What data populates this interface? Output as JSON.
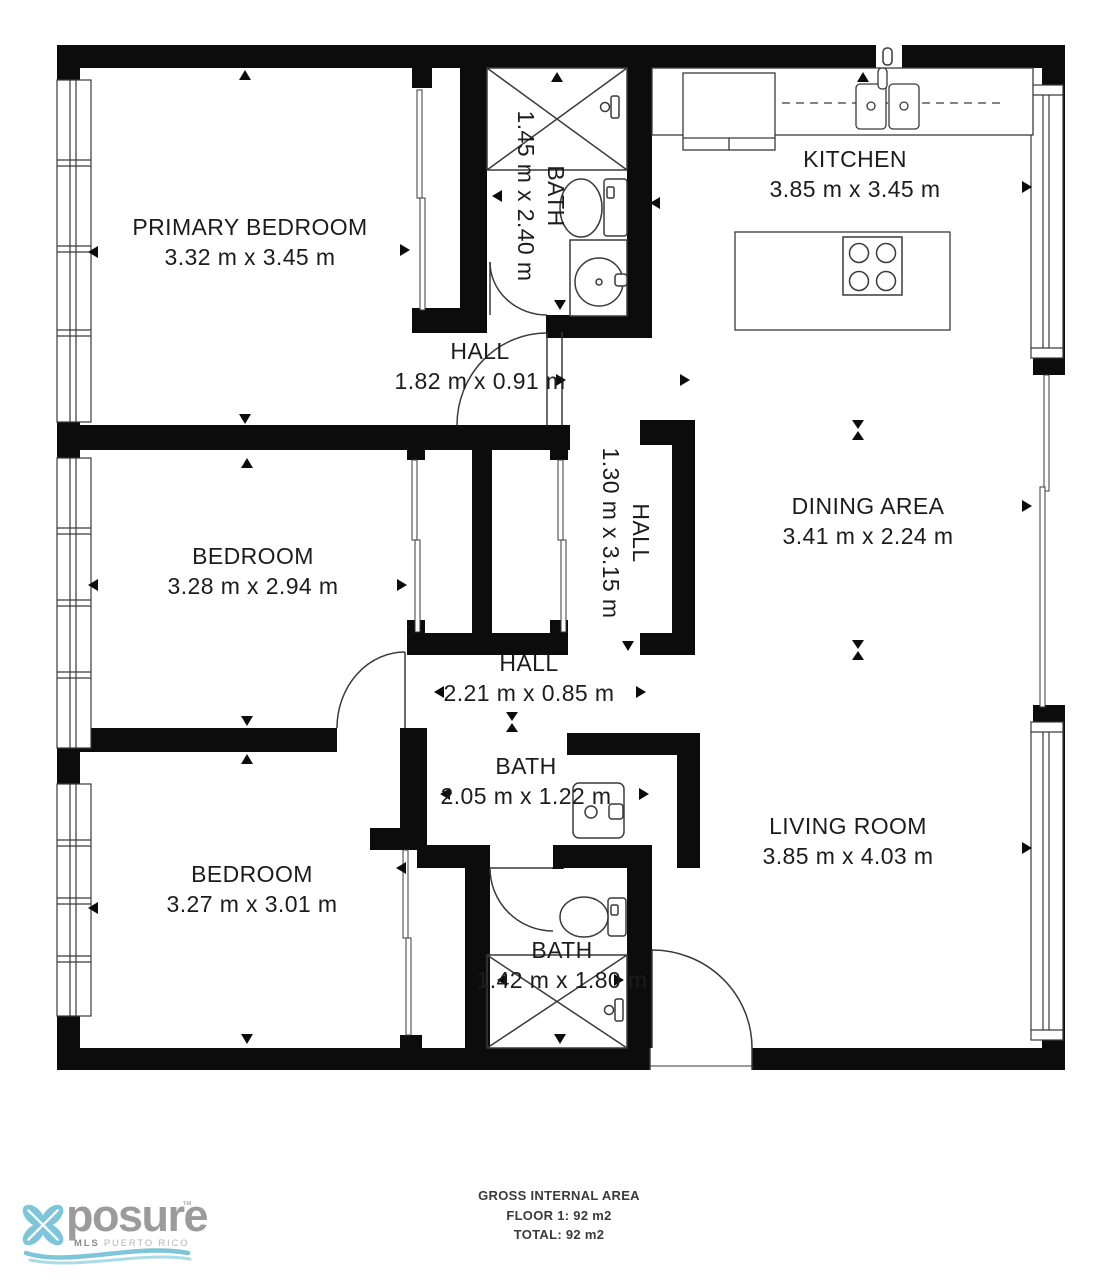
{
  "plan": {
    "rooms": [
      {
        "name": "PRIMARY BEDROOM",
        "dims": "3.32 m x 3.45 m"
      },
      {
        "name": "KITCHEN",
        "dims": "3.85 m x 3.45 m"
      },
      {
        "name": "BATH",
        "dims": "1.45 m x 2.40 m"
      },
      {
        "name": "HALL",
        "dims": "1.82 m x 0.91 m"
      },
      {
        "name": "HALL",
        "dims": "1.30 m x 3.15 m"
      },
      {
        "name": "DINING AREA",
        "dims": "3.41 m x 2.24 m"
      },
      {
        "name": "BEDROOM",
        "dims": "3.28 m x 2.94 m"
      },
      {
        "name": "HALL",
        "dims": "2.21 m x 0.85 m"
      },
      {
        "name": "BATH",
        "dims": "2.05 m x 1.22 m"
      },
      {
        "name": "LIVING ROOM",
        "dims": "3.85 m x 4.03 m"
      },
      {
        "name": "BEDROOM",
        "dims": "3.27 m x 3.01 m"
      },
      {
        "name": "BATH",
        "dims": "1.42 m x 1.80 m"
      }
    ],
    "fixtures": [
      "shower",
      "toilet",
      "sink",
      "vanity",
      "stove",
      "kitchen-island",
      "kitchen-counter",
      "refrigerator",
      "windows",
      "sliding-doors",
      "door-swings"
    ],
    "footer": {
      "title": "GROSS INTERNAL AREA",
      "floor": "FLOOR 1: 92 m2",
      "total": "TOTAL: 92 m2"
    }
  },
  "logo": {
    "brand": "posure",
    "tm": "™",
    "mls": "MLS",
    "region": "PUERTO RICO",
    "accent_color": "#7ec5d9",
    "gray_color": "#9b9b9b"
  },
  "colors": {
    "wall": "#0c0c0c",
    "line": "#3a3a3a",
    "text": "#1c1c1c"
  }
}
